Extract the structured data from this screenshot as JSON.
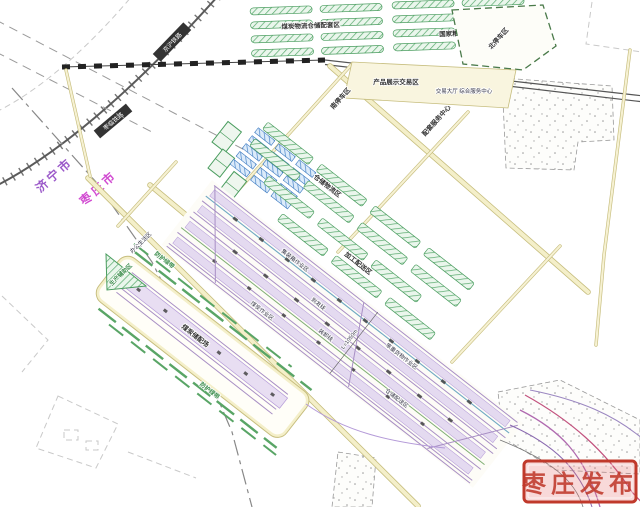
{
  "boundary": {
    "left_city": "济宁市",
    "right_city": "枣庄市"
  },
  "railways": {
    "main_line": "京沪铁路",
    "spur_line": "枣临铁路"
  },
  "zones": {
    "coal_warehouse": "煤炭物流仓储配套区",
    "grain_warehouse": "国家粮食储备库区",
    "north_parking": "北停车区",
    "product_display": "产品展示交易区",
    "trading_hall": "交易大厅 综合服务中心",
    "south_parking": "南停车区",
    "service_center": "配套服务中心",
    "logistics": "仓储物流区",
    "processing": "加工配送区",
    "aux_production": "生产辅助区",
    "office_living": "办公生活区",
    "coal_storage": "煤炭储配场",
    "green_buffer": "防护绿带"
  },
  "yard": {
    "tracks": {
      "container": "集装箱作业区",
      "arrival": "到发线",
      "loading": "装卸线",
      "coal_ops": "煤炭作业区",
      "heavy_cargo": "笨重货物作业区",
      "distribution": "仓储配送区"
    },
    "dimension": "L=1050m"
  },
  "watermark": {
    "text": "枣庄发布"
  },
  "colors": {
    "road_edge": "#c6bd7d",
    "road_fill": "#f4efc9",
    "warehouse_green": "#4a9d5f",
    "building_blue": "#3a78c0",
    "track_purple": "#a88fc4",
    "platform_lavender": "#e4daf0",
    "rail_dark": "#5a5a5a",
    "city_left": "#9b59c9",
    "city_right": "#d14ad1",
    "stamp_red": "#c0392b"
  }
}
